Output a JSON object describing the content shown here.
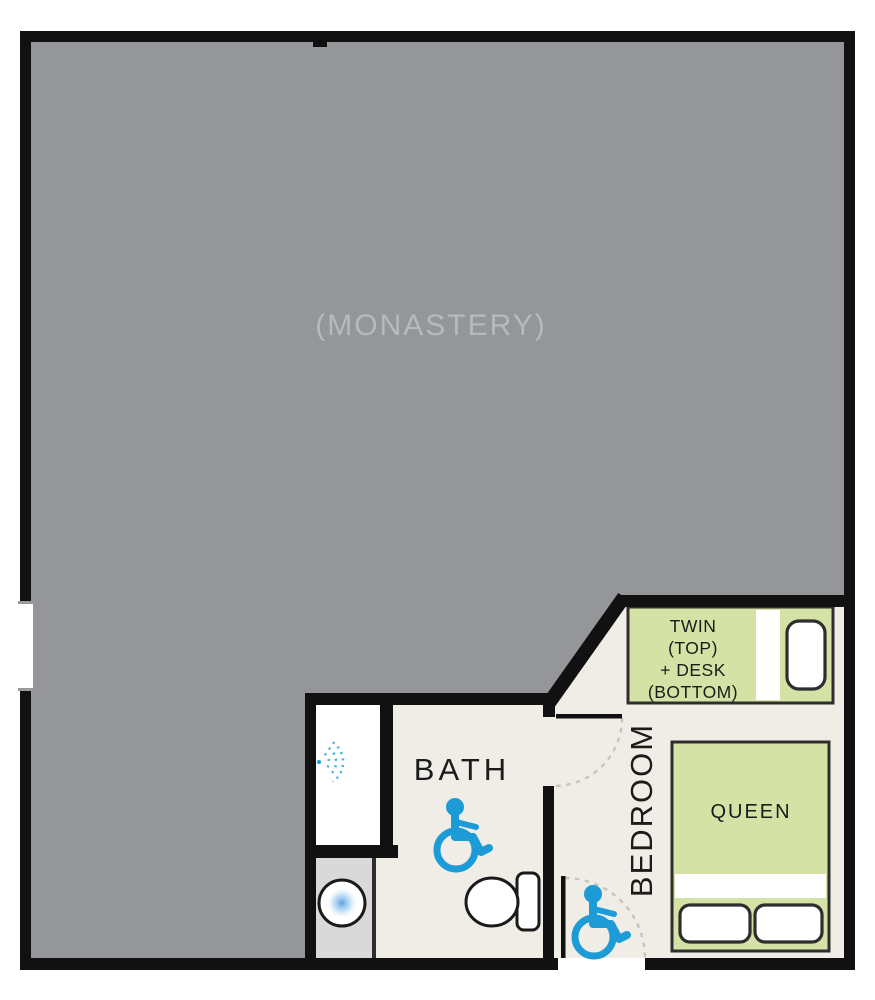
{
  "plan": {
    "rooms": {
      "monastery_label": "(MONASTERY)",
      "bath_label": "BATH",
      "bedroom_label": "BEDROOM"
    },
    "furniture": {
      "twin_bed": {
        "line1": "TWIN",
        "line2": "(TOP)",
        "line3": "+ DESK",
        "line4": "(BOTTOM)"
      },
      "queen_bed": {
        "label": "QUEEN"
      }
    },
    "icons": {
      "bath_accessible": "wheelchair-icon",
      "entrance_accessible": "wheelchair-icon",
      "shower": "shower-spray-icon",
      "sink": "sink-icon",
      "toilet": "toilet-icon"
    },
    "colors": {
      "wall": "#111111",
      "monastery_fill": "#949699",
      "monastery_text": "#b7b9bc",
      "floor": "#f0ede6",
      "bed_fill": "#d5e2a6",
      "bed_border": "#2e2e2e",
      "vanity_fill": "#d9d9d9",
      "accessible_blue": "#1d9bd7",
      "spray_blue": "#3fb5dc",
      "sink_blue": "#4f9fe0",
      "door_arc": "#c7c4be",
      "label_text": "#1b1b1b"
    }
  }
}
